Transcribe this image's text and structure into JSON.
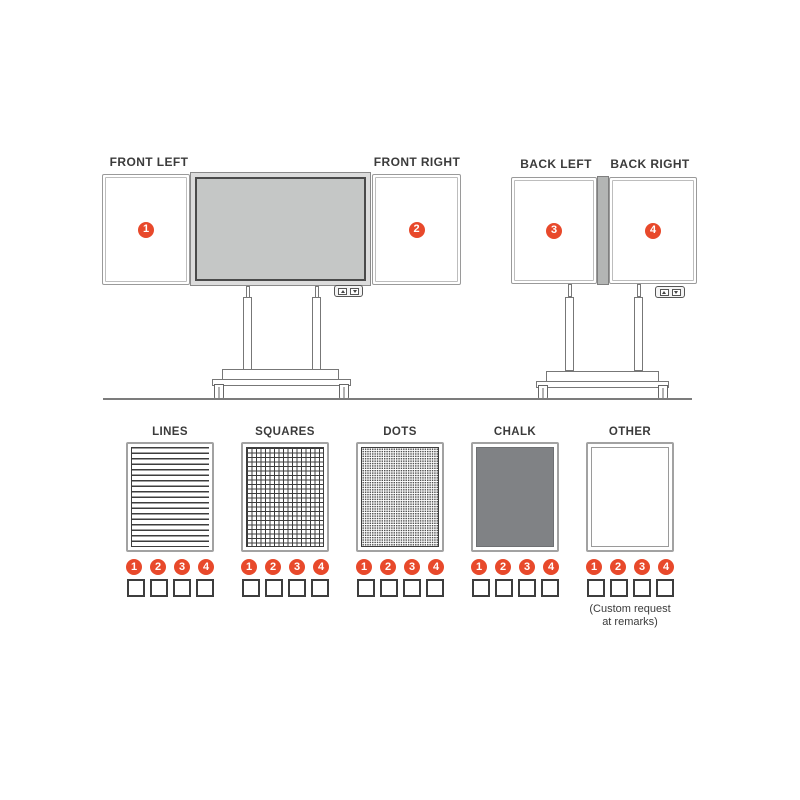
{
  "colors": {
    "accent": "#e8492b",
    "line_dark": "#3d3d3d",
    "frame_gray": "#9a9a9a",
    "screen_fill": "#c5c7c6",
    "chalk_fill": "#808285"
  },
  "front_view": {
    "left_label": "FRONT LEFT",
    "right_label": "FRONT RIGHT",
    "panels": [
      {
        "number": "1"
      },
      {
        "number": "2"
      }
    ]
  },
  "back_view": {
    "left_label": "BACK LEFT",
    "right_label": "BACK RIGHT",
    "panels": [
      {
        "number": "3"
      },
      {
        "number": "4"
      }
    ]
  },
  "badge_numbers": [
    "1",
    "2",
    "3",
    "4"
  ],
  "patterns": [
    {
      "label": "LINES",
      "style": "lines"
    },
    {
      "label": "SQUARES",
      "style": "squares"
    },
    {
      "label": "DOTS",
      "style": "dots"
    },
    {
      "label": "CHALK",
      "style": "chalk"
    },
    {
      "label": "OTHER",
      "style": "other"
    }
  ],
  "note": {
    "line1": "(Custom request",
    "line2": "at remarks)"
  }
}
